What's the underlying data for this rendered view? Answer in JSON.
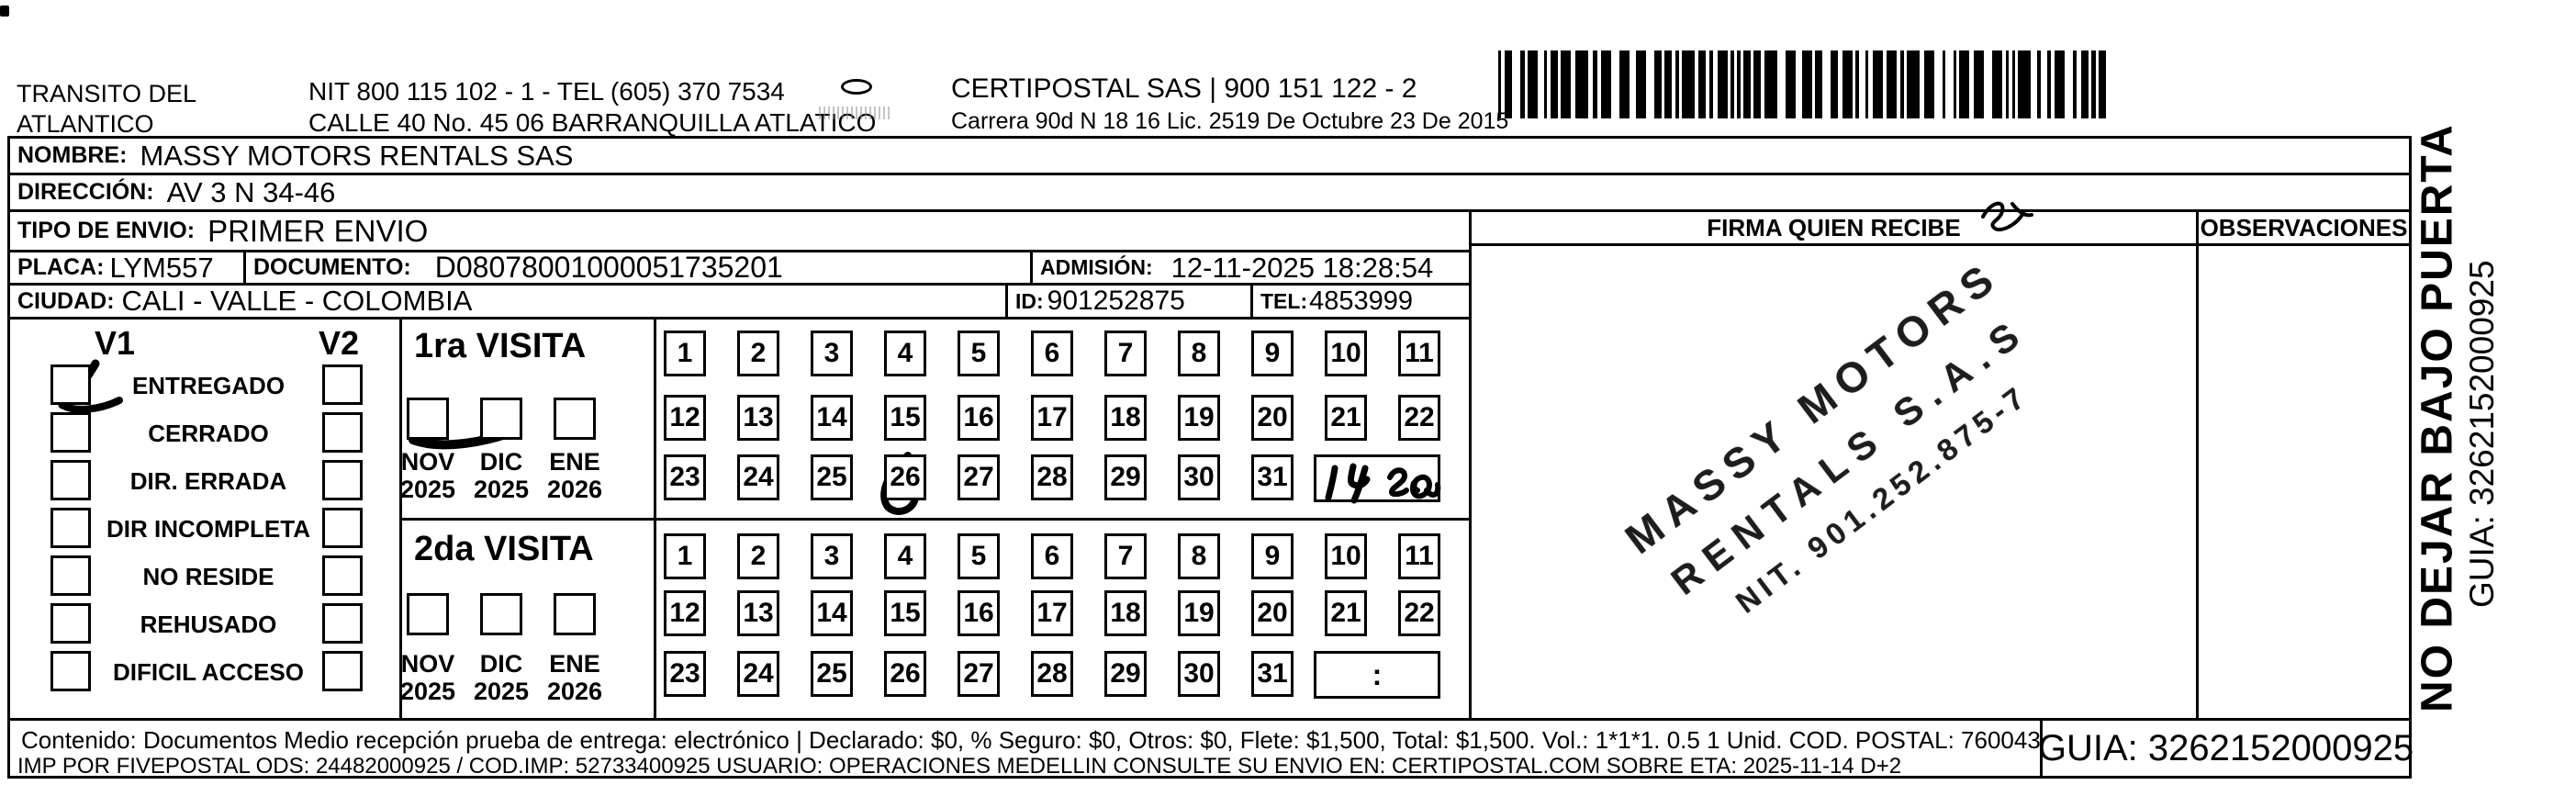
{
  "header": {
    "transito_line1": "TRANSITO DEL",
    "transito_line2": "ATLANTICO",
    "nit_tel": "NIT 800 115 102 - 1 - TEL (605) 370 7534",
    "calle": "CALLE 40 No. 45 06 BARRANQUILLA ATLATICO",
    "certipostal": "CERTIPOSTAL SAS | 900 151 122 - 2",
    "carrera": "Carrera 90d N 18 16  Lic. 2519 De Octubre 23 De 2015"
  },
  "fields": {
    "nombre": {
      "label": "NOMBRE:",
      "value": "MASSY MOTORS RENTALS SAS"
    },
    "direccion": {
      "label": "DIRECCIÓN:",
      "value": "AV 3 N 34-46"
    },
    "tipo_envio": {
      "label": "TIPO DE ENVIO:",
      "value": "PRIMER ENVIO"
    },
    "placa": {
      "label": "PLACA:",
      "value": "LYM557"
    },
    "documento": {
      "label": "DOCUMENTO:",
      "value": "D08078001000051735201"
    },
    "admision": {
      "label": "ADMISIÓN:",
      "value": "12-11-2025 18:28:54"
    },
    "ciudad": {
      "label": "CIUDAD:",
      "value": "CALI - VALLE - COLOMBIA"
    },
    "id": {
      "label": "ID:",
      "value": "901252875"
    },
    "tel": {
      "label": "TEL:",
      "value": "4853999"
    }
  },
  "status": {
    "v1": "V1",
    "v2": "V2",
    "options": [
      "ENTREGADO",
      "CERRADO",
      "DIR. ERRADA",
      "DIR INCOMPLETA",
      "NO RESIDE",
      "REHUSADO",
      "DIFICIL ACCESO"
    ],
    "v1_checked": "ENTREGADO"
  },
  "visits": {
    "months": [
      {
        "label": "NOV",
        "year": "2025"
      },
      {
        "label": "DIC",
        "year": "2025"
      },
      {
        "label": "ENE",
        "year": "2026"
      }
    ],
    "day_rows": [
      [
        1,
        2,
        3,
        4,
        5,
        6,
        7,
        8,
        9,
        10,
        11
      ],
      [
        12,
        13,
        14,
        15,
        16,
        17,
        18,
        19,
        20,
        21,
        22
      ],
      [
        23,
        24,
        25,
        26,
        27,
        28,
        29,
        30,
        31
      ]
    ],
    "first": {
      "title": "1ra VISITA",
      "checked_month": "NOV 2025",
      "marked_day": 26,
      "handwritten_time_note": "14 20"
    },
    "second": {
      "title": "2da VISITA",
      "time_placeholder": ":"
    }
  },
  "firma": {
    "label": "FIRMA QUIEN RECIBE",
    "stamp_lines": [
      "MASSY MOTORS",
      "RENTALS S.A.S",
      "NIT. 901.252.875-7"
    ]
  },
  "observaciones": {
    "label": "OBSERVACIONES"
  },
  "sidebar": {
    "line1": "NO DEJAR BAJO PUERTA",
    "guia": "GUIA: 3262152000925"
  },
  "footer": {
    "line1": "Contenido: Documentos Medio recepción prueba de entrega: electrónico | Declarado: $0, % Seguro: $0, Otros: $0, Flete: $1,500, Total: $1,500. Vol.: 1*1*1. 0.5 1 Unid. COD. POSTAL: 760043",
    "line2": "IMP POR FIVEPOSTAL ODS: 24482000925 / COD.IMP: 52733400925 USUARIO: OPERACIONES MEDELLIN CONSULTE SU ENVIO EN: CERTIPOSTAL.COM SOBRE ETA: 2025-11-14 D+2",
    "guia": "GUIA: 3262152000925"
  }
}
